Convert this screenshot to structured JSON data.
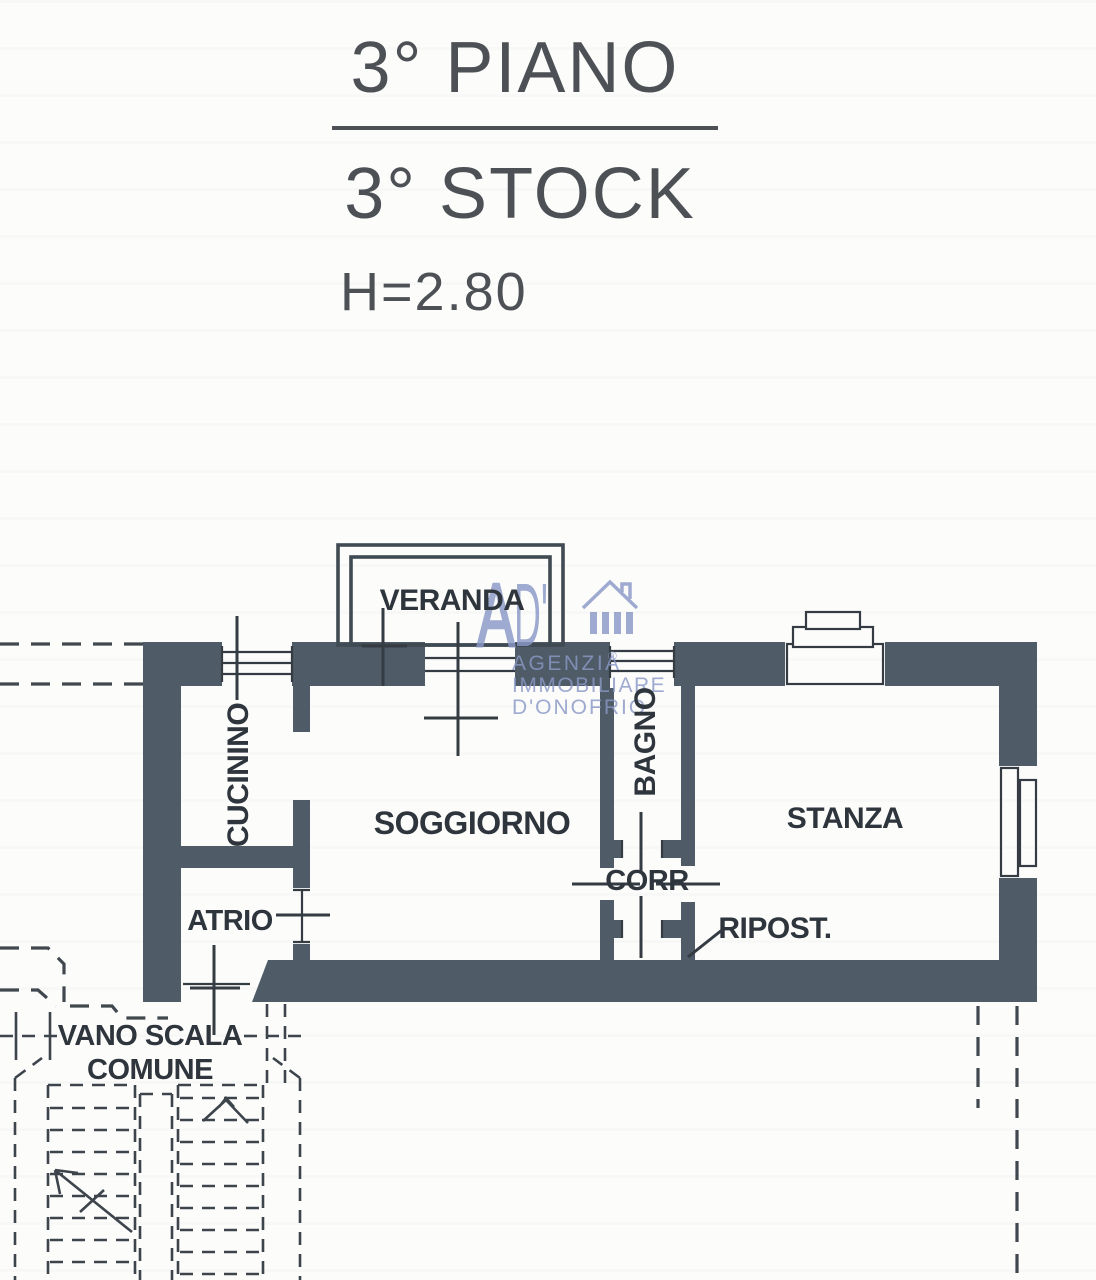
{
  "document": {
    "title_line1": "3° PIANO",
    "title_line2": "3° STOCK",
    "ceiling_height": "H=2.80"
  },
  "watermark": {
    "logo_prefix": "A",
    "logo_suffix": "D'",
    "house_icon": "house-icon",
    "agency_line1": "AGENZIA",
    "registered_symbol": "®",
    "agency_line2": "IMMOBILIARE",
    "agency_line3": "D'ONOFRIO",
    "color": "#8a99c7"
  },
  "rooms": {
    "veranda": {
      "label": "VERANDA"
    },
    "cucinino": {
      "label": "CUCININO"
    },
    "soggiorno": {
      "label": "SOGGIORNO"
    },
    "bagno": {
      "label": "BAGNO"
    },
    "corridoio": {
      "label": "CORR"
    },
    "ripostiglio": {
      "label": "RIPOST."
    },
    "stanza": {
      "label": "STANZA"
    },
    "atrio": {
      "label": "ATRIO"
    },
    "vano_scala": {
      "label_line1": "VANO SCALA",
      "label_line2": "COMUNE"
    }
  },
  "colors": {
    "wall": "#4f5b66",
    "line": "#343b42",
    "stair_dash": "#3d444c",
    "text": "#2e353c",
    "title_text": "#4d5156",
    "watermark": "#8a99c7",
    "background": "#fcfcfb"
  }
}
